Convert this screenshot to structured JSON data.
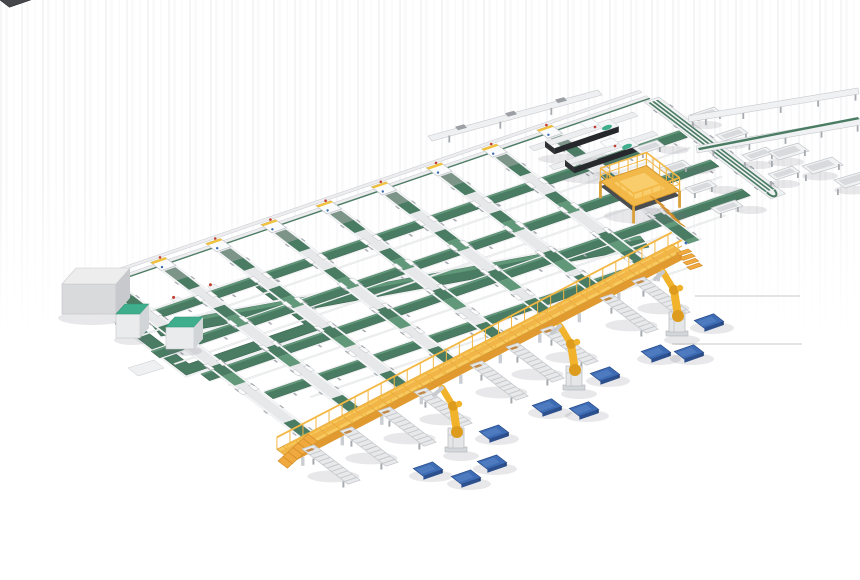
{
  "scene": {
    "title": "Automated parcel sortation and robotic palletizing line - isometric 3D factory render",
    "background": "#ffffff",
    "width": 860,
    "height": 580
  },
  "palette": {
    "belt_green": "#4a7c63",
    "belt_green_dark": "#39624d",
    "belt_green_light": "#619879",
    "frame_white": "#e9eaec",
    "frame_stroke": "#c6c9cd",
    "frame_mid": "#d8dadd",
    "leg_gray": "#a7abb0",
    "walkway_yellow": "#f8c85c",
    "walkway_side": "#e09a30",
    "walkway_rail": "#f3b743",
    "robot_yellow": "#f2b32c",
    "robot_joint": "#dd9c1d",
    "pallet_blue": "#3e6cb4",
    "pallet_blue_dark": "#2c4f8d",
    "pallet_blue_light": "#5b86c8",
    "machine_dark": "#45474b",
    "machine_face": "#2f3134",
    "mint_accent": "#3fae8c",
    "red_accent": "#c23c30",
    "sensor_blue": "#3a6ab0",
    "tan_block": "#c08a4a",
    "shadow": "rgba(110,115,122,0.16)"
  },
  "iso": {
    "origin": [
      80,
      292
    ],
    "u_axis": [
      0.92,
      -0.315
    ],
    "v_axis": [
      0.72,
      0.55
    ]
  },
  "sorter_field": {
    "boundary": {
      "u0": 0,
      "u1": 618,
      "rails_v": [
        -13,
        -3
      ],
      "green_line_v": 1
    },
    "head_stations": {
      "count": 9,
      "u_positions": [
        30,
        90,
        150,
        210,
        270,
        330,
        390,
        450,
        510
      ]
    },
    "sorter_lines": {
      "count": 9,
      "u_centers": [
        30,
        90,
        150,
        210,
        270,
        330,
        390,
        450,
        510
      ],
      "v_start": 6,
      "v_ends": [
        280,
        270,
        260,
        250,
        240,
        231,
        221,
        211,
        201
      ],
      "half_width": 8,
      "green_segments": [
        [
          10,
          44
        ],
        [
          78,
          112
        ],
        [
          150,
          184
        ]
      ],
      "carriage_v": [
        55,
        100,
        145,
        190
      ]
    },
    "cross_belts": [
      {
        "v": 55,
        "u0": -5,
        "u1": 608,
        "w": 12
      },
      {
        "v": 105,
        "u0": -5,
        "u1": 603,
        "w": 12
      },
      {
        "v": 155,
        "u0": 10,
        "u1": 598,
        "w": 12
      },
      {
        "v": 205,
        "u0": 40,
        "u1": 428,
        "w": 12
      }
    ],
    "cross_rails_v": [
      80,
      130,
      180,
      230
    ],
    "wide_floor_belt": {
      "x1": 152,
      "y1": 325,
      "x2": 640,
      "y2": 236,
      "width": 14
    }
  },
  "recirculation_loop": {
    "u0": -2,
    "v0": 55,
    "u1": 150,
    "v1": 150,
    "belt_w": 13,
    "marker_u": [
      25,
      65,
      105
    ]
  },
  "cabinets": {
    "gray_cabinet": {
      "x": 62,
      "y": 268,
      "w": 54,
      "h": 30,
      "top_dx": 14,
      "top_dy": -16
    },
    "teal_cabinets": [
      {
        "x": 116,
        "y": 304,
        "w": 24,
        "h": 24
      },
      {
        "x": 166,
        "y": 317,
        "w": 28,
        "h": 22
      }
    ]
  },
  "infeed_rail": {
    "x1": 428,
    "y1": 136,
    "x2": 598,
    "y2": 90,
    "items_x": [
      455,
      505,
      555
    ]
  },
  "scanner_machines": [
    {
      "x": 545,
      "y": 141
    },
    {
      "x": 565,
      "y": 160
    }
  ],
  "sortation_spur": {
    "u0": 610,
    "u_w": 16,
    "v0": 4,
    "v1": 180,
    "belt_u": [
      612.5,
      616.5,
      620.5
    ],
    "bins_ne": [
      [
        690,
        115
      ],
      [
        716,
        135
      ],
      [
        742,
        155
      ],
      [
        768,
        174
      ]
    ],
    "bins_sw": [
      [
        657,
        140
      ],
      [
        683,
        160
      ],
      [
        709,
        180
      ],
      [
        735,
        200
      ]
    ]
  },
  "right_rails": [
    {
      "x1": 688,
      "y1": 116,
      "x2": 858,
      "y2": 88,
      "w": 6,
      "green": false
    },
    {
      "x1": 696,
      "y1": 146,
      "x2": 860,
      "y2": 118,
      "w": 7,
      "green": true
    }
  ],
  "right_bins": [
    [
      768,
      152
    ],
    [
      802,
      166
    ],
    [
      834,
      180
    ]
  ],
  "mezzanine_platform": {
    "cx": 640,
    "cy": 186,
    "half_u": 25,
    "half_v": 23,
    "rail_h": 13,
    "stairs": {
      "x": 650,
      "y": 196,
      "steps": 5
    }
  },
  "elevated_walkway": {
    "sw": [
      287,
      457
    ],
    "ne": [
      682,
      252
    ],
    "deck_w": 14,
    "rail_h": 12,
    "side_h": 8,
    "sw_stairs": {
      "x": 308,
      "y": 434,
      "steps": 6
    },
    "ne_stairs": {
      "x": 676,
      "y": 253,
      "steps": 4
    }
  },
  "outfeed_lanes": {
    "count": 9,
    "length": 58,
    "width": 13,
    "origins": [
      [
        302,
        449
      ],
      [
        340,
        431
      ],
      [
        378,
        411
      ],
      [
        414,
        392
      ],
      [
        470,
        365
      ],
      [
        506,
        347
      ],
      [
        540,
        330
      ],
      [
        600,
        298
      ],
      [
        632,
        281
      ]
    ]
  },
  "palletizing_robots": {
    "count": 3,
    "pedestal_top": [
      [
        456,
        428
      ],
      [
        574,
        366
      ],
      [
        677,
        312
      ]
    ]
  },
  "pallets": {
    "count": 10,
    "centers": [
      [
        428,
        469
      ],
      [
        466,
        477
      ],
      [
        492,
        462
      ],
      [
        494,
        432
      ],
      [
        547,
        406
      ],
      [
        584,
        409
      ],
      [
        605,
        374
      ],
      [
        656,
        352
      ],
      [
        689,
        352
      ],
      [
        709,
        321
      ]
    ]
  },
  "floor_lines": [
    {
      "x1": 695,
      "y1": 296,
      "x2": 800,
      "y2": 296
    },
    {
      "x1": 672,
      "y1": 344,
      "x2": 802,
      "y2": 344
    }
  ]
}
